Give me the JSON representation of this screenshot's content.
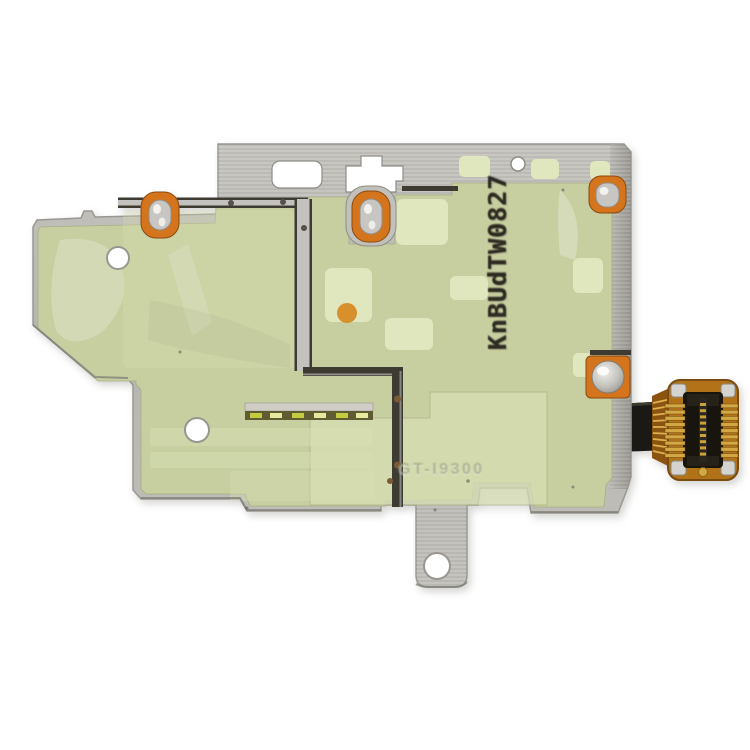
{
  "photo": {
    "description": "Macro product photo of a SIM / memory card reader flex-cable module with a stamped metal EMI shield covered by pale green protective film, on a white background",
    "background_color": "#ffffff",
    "markings": {
      "stamp_code": "KnBUdTW0827",
      "embossed_code": "GT-I9300"
    },
    "colors": {
      "background": "#ffffff",
      "film_green": "#c7cfa0",
      "film_light": "#d8dfb4",
      "film_patch": "#e0e6bd",
      "metal": "#bbb9b4",
      "metal_dark": "#a3a19c",
      "metal_bright": "#d8d6d2",
      "seam": "#3e3b33",
      "grommet_orange": "#d4741c",
      "flex_orange": "#b27318",
      "flex_dark": "#6e4410",
      "gold": "#d2a844",
      "socket_black": "#18140e",
      "stamp_ink": "#221e18"
    }
  }
}
